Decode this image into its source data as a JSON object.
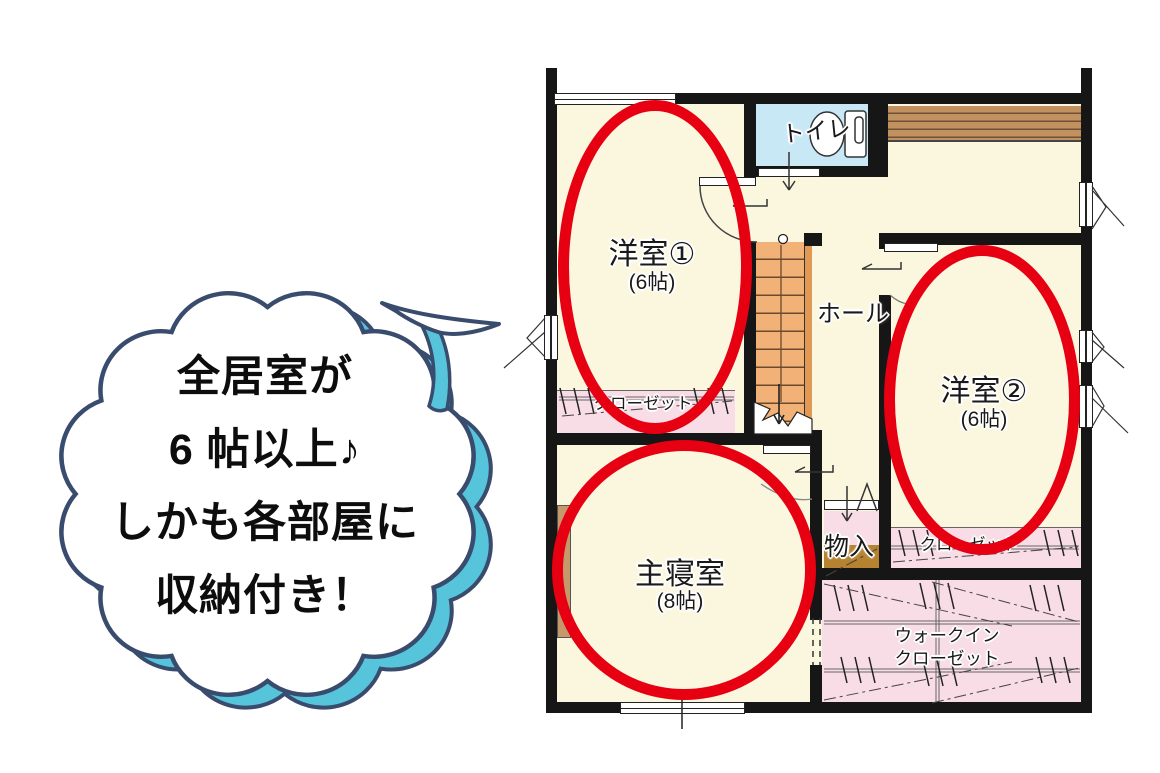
{
  "bubble": {
    "lines": [
      "全居室が",
      "6 帖以上♪",
      "しかも各部屋に",
      "収納付き！"
    ]
  },
  "plan": {
    "rooms": {
      "west1": {
        "label": "洋室①",
        "size": "(6帖)"
      },
      "west2": {
        "label": "洋室②",
        "size": "(6帖)"
      },
      "master": {
        "label": "主寝室",
        "size": "(8帖)"
      }
    },
    "labels": {
      "toilet": "トイレ",
      "hall": "ホール",
      "storage": "物入",
      "closet1": "クローゼット",
      "closet2": "クローゼット",
      "wic1": "ウォークイン",
      "wic2": "クローゼット"
    }
  },
  "colors": {
    "highlight_red": "#E60012",
    "wall_black": "#161616",
    "floor_cream": "#FBF7DF",
    "closet_pink": "#F8DCE6",
    "toilet_blue": "#C9E8F6",
    "stair_orange": "#F2B176",
    "wood_brown": "#C1915F",
    "storage_brown": "#B5822F",
    "bubble_outline": "#3A4C6E",
    "bubble_cyan": "#56C5DB"
  }
}
